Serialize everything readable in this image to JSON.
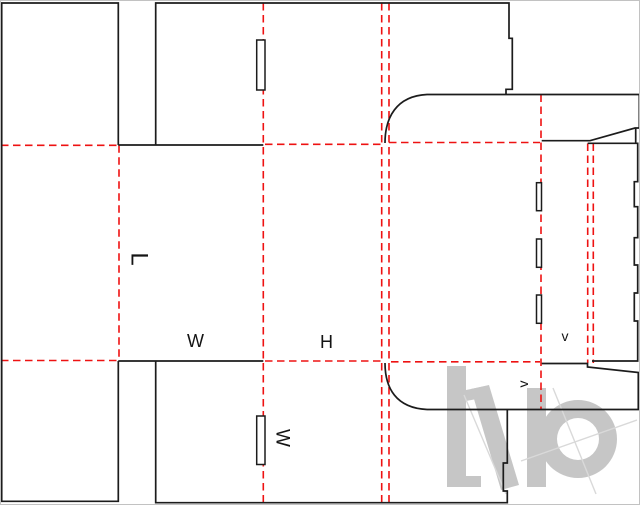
{
  "dieline": {
    "canvas": {
      "width": 640,
      "height": 505,
      "background": "#ffffff",
      "frame_color": "#c2c2c2"
    },
    "style": {
      "cut_color": "#1c1c1c",
      "cut_width": 1.7,
      "fold_color": "#ee1212",
      "fold_width": 1.6,
      "fold_dash": "7.5 4.5",
      "label_color": "#141414"
    },
    "cut_paths": [
      "M118.3 145 L118.3 3 L1.7 3 L1.7 501.3 L118.3 501.3 L118.3 361",
      "M118.3 145 L263.3 145",
      "M118.3 361 L263.3 361",
      "M155.7 145 L155.7 3 L509 3 L509 38.3 L512.3 38.3 L512.3 89.3 L506 89.3 L506 94.5",
      "M385 143 C385 118 396 96 427 94.5 L639.3 94.5 L639.3 128 L635 128 L590 140.7 L541.7 140.7",
      "M635.7 128 L635.7 143.3",
      "M587.7 143.3 L637.7 143.3 L637.7 181.7 L634.3 181.7 L634.3 206.7 L637.7 206.7 L637.7 237.7 L634.3 237.7 L634.3 265 L637.7 265 L637.7 293 L634.3 293 L634.3 321 L637.7 321 L637.7 361 L592 361",
      "M541.7 363.5 L587.5 363.5 L587.5 367 L638.3 372.5 L638.3 409.5 L427 409.5",
      "M385 363 C385 388 396 408 427 409.5",
      "M155.7 361 L155.7 502.7 L507.3 502.7 L507.3 491 L503.3 491 L503.3 463 L507.3 463 L507.3 409.5"
    ],
    "slots": [
      {
        "x": 256.7,
        "y": 40,
        "w": 8.3,
        "h": 50
      },
      {
        "x": 256.7,
        "y": 416,
        "w": 8.3,
        "h": 48.5
      },
      {
        "x": 536.5,
        "y": 182.7,
        "w": 5,
        "h": 28
      },
      {
        "x": 536.5,
        "y": 239,
        "w": 5,
        "h": 28.3
      },
      {
        "x": 536.5,
        "y": 295,
        "w": 5,
        "h": 28.3
      }
    ],
    "fold_lines": [
      {
        "x1": 1,
        "y1": 145.3,
        "x2": 118,
        "y2": 145.3
      },
      {
        "x1": 265,
        "y1": 144.3,
        "x2": 381.7,
        "y2": 144.3
      },
      {
        "x1": 389,
        "y1": 142.5,
        "x2": 540,
        "y2": 142.5
      },
      {
        "x1": 1,
        "y1": 360.5,
        "x2": 118,
        "y2": 360.5
      },
      {
        "x1": 265,
        "y1": 361,
        "x2": 381.7,
        "y2": 361
      },
      {
        "x1": 391,
        "y1": 361.8,
        "x2": 540,
        "y2": 361.8
      },
      {
        "x1": 119,
        "y1": 145.3,
        "x2": 119,
        "y2": 360.5
      },
      {
        "x1": 263.3,
        "y1": 3,
        "x2": 263.3,
        "y2": 502.7
      },
      {
        "x1": 381.7,
        "y1": 3,
        "x2": 381.7,
        "y2": 502.7
      },
      {
        "x1": 389,
        "y1": 3,
        "x2": 389,
        "y2": 502.7
      },
      {
        "x1": 541,
        "y1": 94.5,
        "x2": 541,
        "y2": 409.5
      },
      {
        "x1": 587.7,
        "y1": 143.5,
        "x2": 587.7,
        "y2": 363
      },
      {
        "x1": 593.3,
        "y1": 143.5,
        "x2": 593.3,
        "y2": 363
      }
    ],
    "labels": [
      {
        "id": "length-label",
        "text": "L",
        "x": 139,
        "y": 259,
        "rotate": 90,
        "size": 24
      },
      {
        "id": "width-label",
        "text": "W",
        "x": 195.5,
        "y": 341,
        "rotate": 0,
        "size": 18
      },
      {
        "id": "height-label",
        "text": "H",
        "x": 326.5,
        "y": 342,
        "rotate": 0,
        "size": 18
      },
      {
        "id": "width-flap-label",
        "text": "W",
        "x": 282,
        "y": 438,
        "rotate": 90,
        "size": 19
      },
      {
        "id": "v-panel-label",
        "text": "v",
        "x": 565,
        "y": 336,
        "rotate": 0,
        "size": 14
      },
      {
        "id": "v-flap-label",
        "text": "v",
        "x": 523,
        "y": 384,
        "rotate": -90,
        "size": 14
      }
    ],
    "watermark": {
      "fill": "#c6c6c6",
      "line_color": "#d9d9d9",
      "h_stem": {
        "x": 447,
        "y": 366,
        "w": 19,
        "h": 121
      },
      "h_foot": {
        "x": 447,
        "y": 476,
        "w": 34,
        "h": 11
      },
      "h_leg": [
        [
          471,
          389
        ],
        [
          489,
          385
        ],
        [
          519,
          485
        ],
        [
          501,
          490
        ]
      ],
      "h_arch": [
        [
          466,
          390
        ],
        [
          486,
          386
        ],
        [
          482,
          398
        ],
        [
          466,
          401
        ]
      ],
      "b_stem": {
        "x": 527,
        "y": 388,
        "w": 19,
        "h": 99
      },
      "ring": {
        "cx": 578,
        "cy": 439,
        "r_outer": 39,
        "r_inner": 21
      },
      "cross_a": {
        "x1": 521,
        "y1": 461,
        "x2": 637,
        "y2": 420
      },
      "cross_b": {
        "x1": 553,
        "y1": 388,
        "x2": 596,
        "y2": 494
      },
      "slash": {
        "x1": 464,
        "y1": 395,
        "x2": 506,
        "y2": 494
      }
    }
  }
}
